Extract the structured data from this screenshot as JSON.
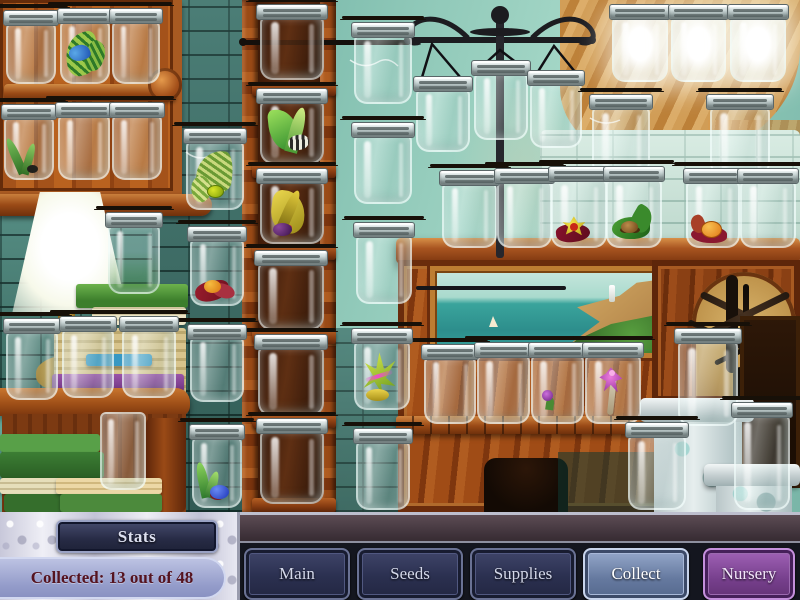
{
  "hud": {
    "stats_button": "Stats",
    "collected_text": "Collected: 13 out of 48",
    "collected_count": 13,
    "collected_total": 48
  },
  "toolbar": {
    "buttons": [
      {
        "label": "Main",
        "variant": ""
      },
      {
        "label": "Seeds",
        "variant": ""
      },
      {
        "label": "Supplies",
        "variant": ""
      },
      {
        "label": "Collect",
        "variant": "active"
      },
      {
        "label": "Nursery",
        "variant": "nursery"
      }
    ]
  },
  "colors": {
    "active_button": "#7b93bd",
    "nursery_button": "#9256ab",
    "button_navy": "#343a55",
    "collected_pill": "#9ba3d2",
    "collected_text_color": "#55131f",
    "wall_teal": "#8fc8b8",
    "wood_orange": "#a04c16"
  },
  "jars": [
    {
      "x": 6,
      "y": 12,
      "w": 50,
      "h": 72
    },
    {
      "x": 60,
      "y": 10,
      "w": 50,
      "h": 74,
      "specimen": "blue-butterfly"
    },
    {
      "x": 112,
      "y": 10,
      "w": 48,
      "h": 74
    },
    {
      "x": 4,
      "y": 106,
      "w": 50,
      "h": 74,
      "specimen": "grass-bug"
    },
    {
      "x": 58,
      "y": 104,
      "w": 52,
      "h": 76
    },
    {
      "x": 112,
      "y": 104,
      "w": 50,
      "h": 76
    },
    {
      "x": 186,
      "y": 130,
      "w": 58,
      "h": 80,
      "specimen": "curl-leaf-bug"
    },
    {
      "x": 190,
      "y": 228,
      "w": 54,
      "h": 78,
      "specimen": "red-leaf-orange-bug"
    },
    {
      "x": 190,
      "y": 326,
      "w": 54,
      "h": 76
    },
    {
      "x": 192,
      "y": 426,
      "w": 50,
      "h": 82,
      "specimen": "sprout-blue-bug"
    },
    {
      "x": 260,
      "y": 6,
      "w": 64,
      "h": 74,
      "style": "dark"
    },
    {
      "x": 260,
      "y": 90,
      "w": 64,
      "h": 74,
      "style": "dark",
      "specimen": "stripe-beetle"
    },
    {
      "x": 260,
      "y": 170,
      "w": 64,
      "h": 74,
      "style": "dark",
      "specimen": "yellow-leaf-purple-bug"
    },
    {
      "x": 258,
      "y": 252,
      "w": 66,
      "h": 78,
      "style": "dark"
    },
    {
      "x": 258,
      "y": 336,
      "w": 66,
      "h": 80,
      "style": "dark"
    },
    {
      "x": 260,
      "y": 420,
      "w": 64,
      "h": 84,
      "style": "dark"
    },
    {
      "x": 354,
      "y": 24,
      "w": 58,
      "h": 80
    },
    {
      "x": 354,
      "y": 124,
      "w": 58,
      "h": 80
    },
    {
      "x": 356,
      "y": 224,
      "w": 56,
      "h": 80
    },
    {
      "x": 354,
      "y": 330,
      "w": 56,
      "h": 80,
      "specimen": "magenta-dragonfly"
    },
    {
      "x": 356,
      "y": 430,
      "w": 54,
      "h": 80
    },
    {
      "x": 416,
      "y": 78,
      "w": 54,
      "h": 74,
      "hang": true
    },
    {
      "x": 474,
      "y": 62,
      "w": 54,
      "h": 78,
      "hang": true
    },
    {
      "x": 530,
      "y": 72,
      "w": 52,
      "h": 76,
      "hang": true
    },
    {
      "x": 612,
      "y": 6,
      "w": 56,
      "h": 76,
      "style": "glow"
    },
    {
      "x": 671,
      "y": 6,
      "w": 55,
      "h": 76,
      "style": "glow"
    },
    {
      "x": 730,
      "y": 6,
      "w": 56,
      "h": 76,
      "style": "glow"
    },
    {
      "x": 592,
      "y": 96,
      "w": 58,
      "h": 80
    },
    {
      "x": 710,
      "y": 96,
      "w": 60,
      "h": 80
    },
    {
      "x": 442,
      "y": 172,
      "w": 55,
      "h": 76
    },
    {
      "x": 497,
      "y": 170,
      "w": 55,
      "h": 78
    },
    {
      "x": 551,
      "y": 168,
      "w": 56,
      "h": 80,
      "specimen": "yellow-dragonfly"
    },
    {
      "x": 606,
      "y": 168,
      "w": 56,
      "h": 80,
      "specimen": "green-leaf-spider"
    },
    {
      "x": 686,
      "y": 170,
      "w": 54,
      "h": 78,
      "specimen": "orange-fruit-bug"
    },
    {
      "x": 740,
      "y": 170,
      "w": 56,
      "h": 78
    },
    {
      "x": 424,
      "y": 346,
      "w": 52,
      "h": 78
    },
    {
      "x": 477,
      "y": 344,
      "w": 53,
      "h": 80
    },
    {
      "x": 531,
      "y": 344,
      "w": 53,
      "h": 80,
      "specimen": "purple-floret"
    },
    {
      "x": 585,
      "y": 344,
      "w": 56,
      "h": 80,
      "specimen": "purple-orchid-bug"
    },
    {
      "x": 628,
      "y": 424,
      "w": 58,
      "h": 86
    },
    {
      "x": 678,
      "y": 330,
      "w": 60,
      "h": 96
    },
    {
      "x": 734,
      "y": 404,
      "w": 56,
      "h": 106
    },
    {
      "x": 108,
      "y": 214,
      "w": 52,
      "h": 80,
      "style": "tint"
    },
    {
      "x": 6,
      "y": 320,
      "w": 52,
      "h": 80
    },
    {
      "x": 62,
      "y": 318,
      "w": 52,
      "h": 80
    },
    {
      "x": 122,
      "y": 318,
      "w": 54,
      "h": 80
    },
    {
      "x": 100,
      "y": 412,
      "w": 46,
      "h": 78,
      "style": "nolid"
    }
  ]
}
